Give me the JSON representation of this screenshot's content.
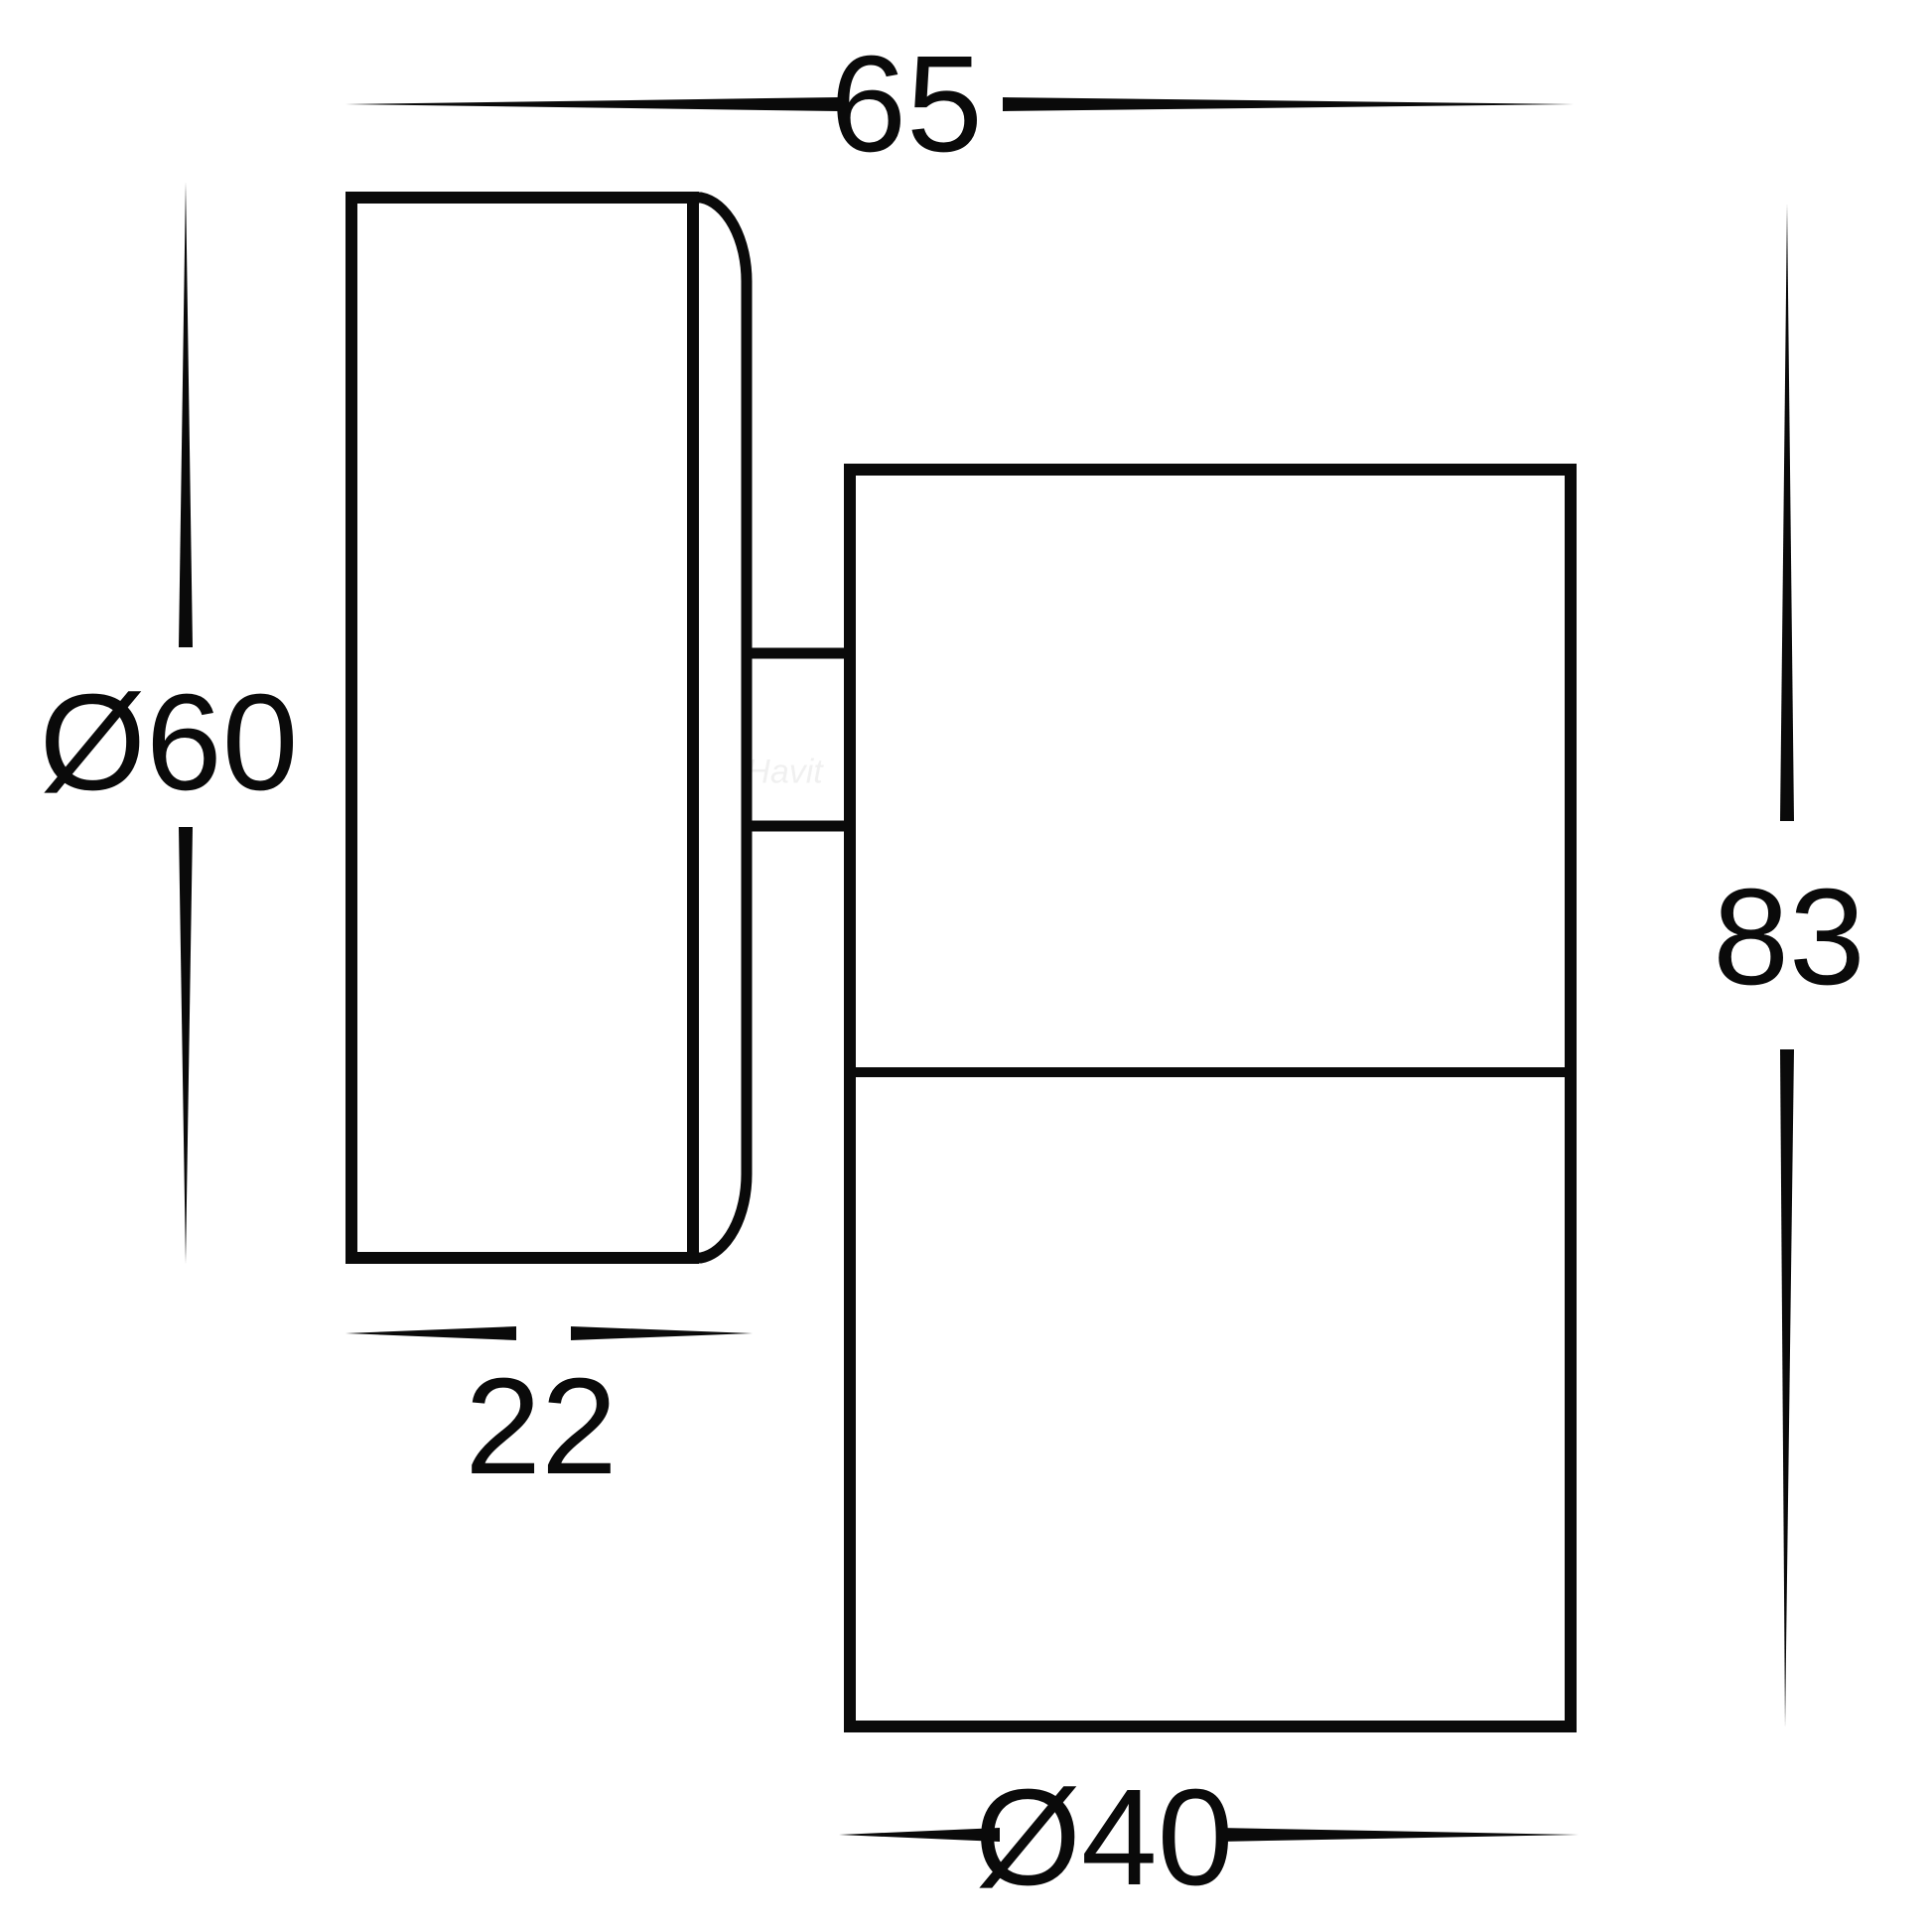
{
  "page": {
    "background": "#ffffff",
    "line_color": "#0a0a0a"
  },
  "watermark": {
    "text": "Havit"
  },
  "dims": {
    "top": {
      "label": "65"
    },
    "left": {
      "label": "Ø60"
    },
    "right": {
      "label": "83"
    },
    "plate_depth": {
      "label": "22"
    },
    "bottom": {
      "label": "Ø40"
    }
  }
}
